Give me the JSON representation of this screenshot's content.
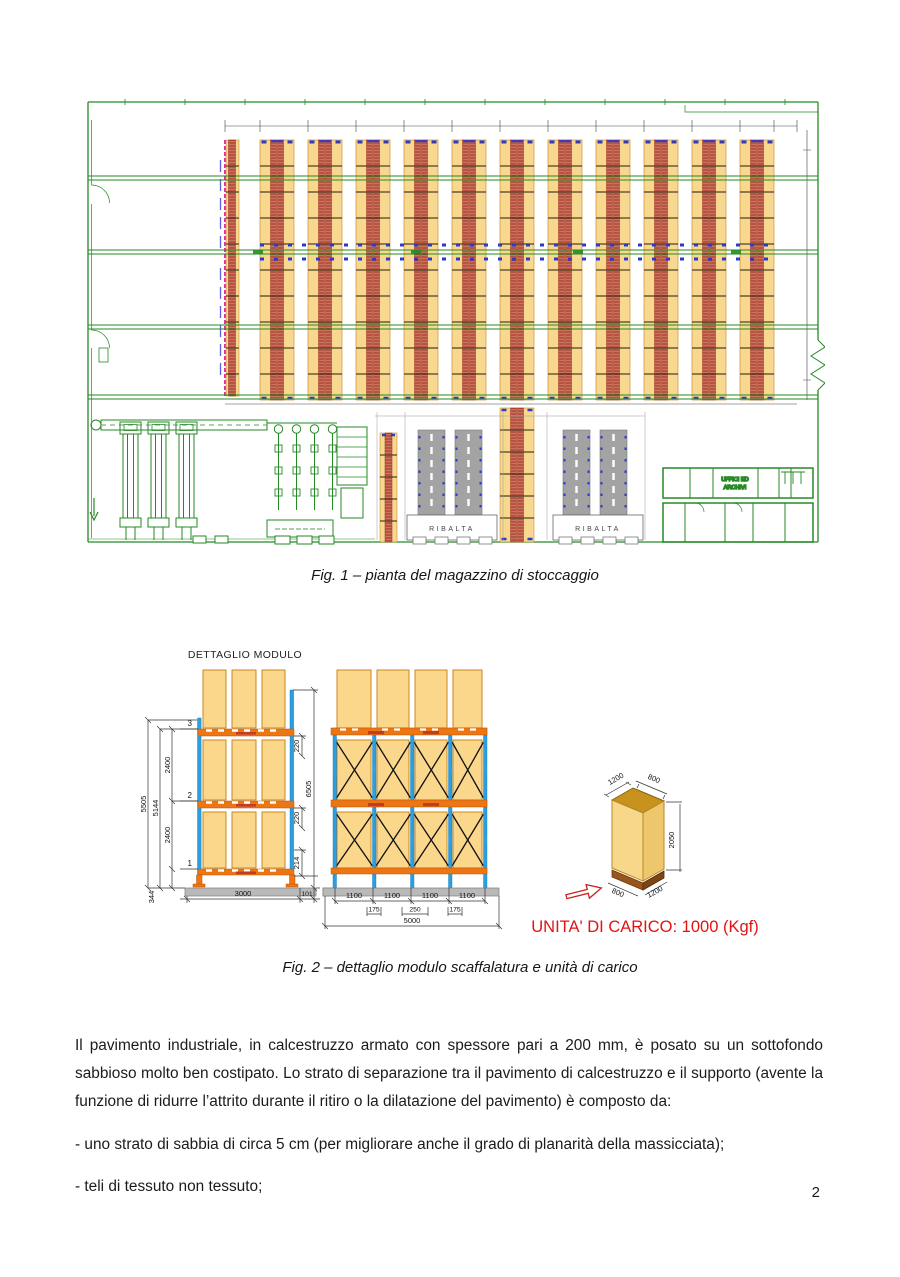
{
  "page": {
    "number": "2"
  },
  "fig1": {
    "caption": "Fig. 1 – pianta del magazzino di stoccaggio",
    "labels": {
      "ribalta": "RIBALTA",
      "offices_line1": "UFFICI ED",
      "offices_line2": "ARCHIVI"
    }
  },
  "fig2": {
    "caption": "Fig. 2 – dettaglio modulo scaffalatura e unità di carico",
    "module_title": "DETTAGLIO MODULO",
    "side_view": {
      "levels": [
        "1",
        "2",
        "3"
      ],
      "overall_height": "5505",
      "height_to_top_beam": "5144",
      "level_spacing_upper": "2400",
      "level_spacing_lower": "2400",
      "base_height": "344",
      "top_clearance": "220",
      "mid_clearance": "220",
      "first_beam_height": "214",
      "upright_total": "6505",
      "module_width": "3000",
      "side_offset": "101"
    },
    "front_view": {
      "bay_widths": [
        "1100",
        "1100",
        "1100",
        "1100"
      ],
      "upright_spacings": [
        "175",
        "250",
        "175"
      ],
      "total_width": "5000"
    },
    "unit_load": {
      "top_depth": "1200",
      "top_width": "800",
      "height": "2050",
      "base_width": "800",
      "base_depth": "1200",
      "label": "UNITA' DI CARICO: 1000 (Kgf)"
    }
  },
  "body": {
    "paragraph": "Il pavimento industriale, in calcestruzzo armato con spessore pari a 200 mm, è posato su un sottofondo sabbioso molto ben costipato. Lo strato di separazione tra il pavimento di calcestruzzo e il supporto (avente la funzione di ridurre l’attrito durante il ritiro o la dilatazione del pavimento) è composto da:",
    "bullet1": "- uno strato di sabbia di circa 5 cm (per migliorare anche il grado di planarità della massicciata);",
    "bullet2": "- teli di tessuto non tessuto;"
  },
  "colors": {
    "cad_green": "#258a25",
    "rack_yellow": "#f8d88e",
    "hatch_red": "#a93022",
    "shuttle_blue": "#2a3bd0",
    "upright_blue": "#2b9fe0",
    "beam_orange": "#ee7612",
    "magenta": "#e12ba7",
    "unit_load_red": "#e31212",
    "floor_gray": "#b9b9b9"
  }
}
